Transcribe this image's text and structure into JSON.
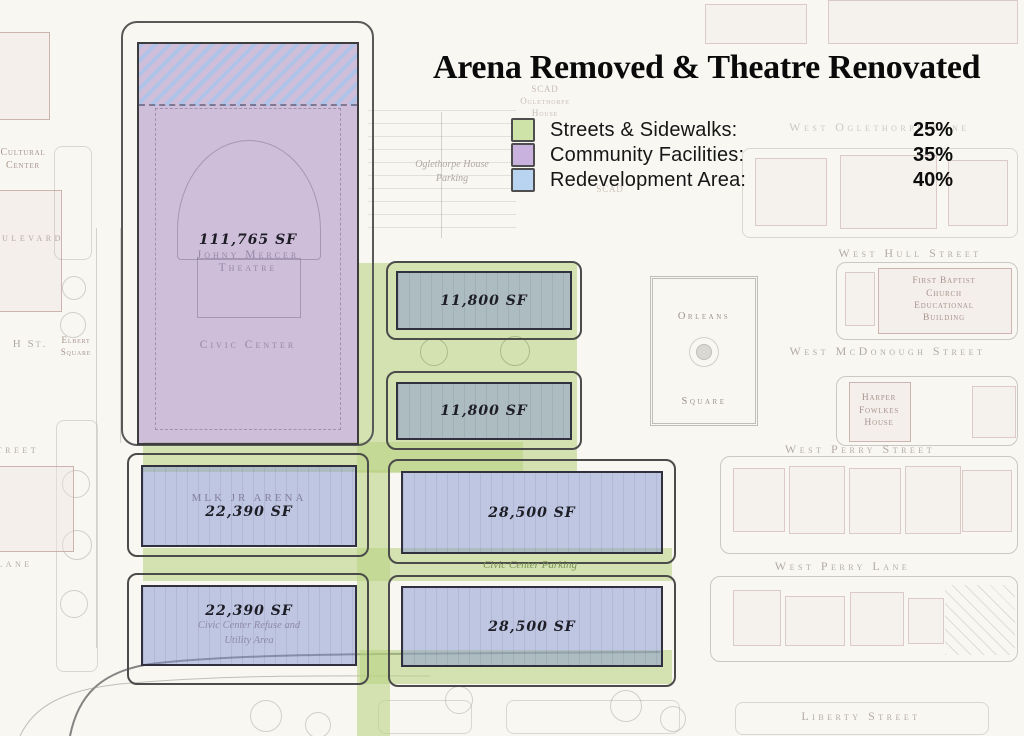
{
  "title": "Arena Removed & Theatre Renovated",
  "legend": {
    "items": [
      {
        "label": "Streets & Sidewalks:",
        "value": "25%",
        "color": "#cde3a7"
      },
      {
        "label": "Community Facilities:",
        "value": "35%",
        "color": "#c9b3de"
      },
      {
        "label": "Redevelopment Area:",
        "value": "40%",
        "color": "#b9d4f1"
      }
    ]
  },
  "colors": {
    "streets_overlay": "rgba(183,209,126,0.55)",
    "community_overlay": "rgba(158,120,188,0.45)",
    "redevelopment_overlay": "rgba(134,150,208,0.5)",
    "hatch_blue": "#a8c4ea"
  },
  "plan": {
    "theatre": {
      "area": "111,765 SF",
      "name": [
        "Johny Mercer",
        "Theatre"
      ],
      "facility": "Civic Center"
    },
    "blocks": [
      {
        "area": "11,800 SF"
      },
      {
        "area": "11,800 SF"
      },
      {
        "area": "22,390 SF",
        "ghost": "MLK JR ARENA"
      },
      {
        "area": "22,390 SF",
        "note": [
          "Civic Center Refuse and",
          "Utility Area"
        ]
      },
      {
        "area": "28,500 SF"
      },
      {
        "area": "28,500 SF"
      }
    ],
    "parking_label": "Civic Center Parking"
  },
  "map": {
    "streets": {
      "west_oglethorpe_lane": "West Oglethorpe Lane",
      "west_hull_street": "West Hull Street",
      "west_mcdonough_street": "West McDonough Street",
      "west_perry_street": "West Perry Street",
      "west_perry_lane": "West Perry Lane",
      "liberty_street": "Liberty Street",
      "boulevard_partial": "ulevard",
      "h_st": "H St.",
      "street_partial": "treet",
      "lane_partial": "lane"
    },
    "places": {
      "scad_house": [
        "SCAD",
        "Oglethorpe",
        "House"
      ],
      "oglethorpe_parking": [
        "Oglethorpe House",
        "Parking"
      ],
      "scad_small": "SCAD",
      "first_baptist": [
        "First Baptist",
        "Church",
        "Educational",
        "Building"
      ],
      "harper_fowlkes": [
        "Harper",
        "Fowlkes",
        "House"
      ],
      "orleans_square": [
        "Orleans",
        "Square"
      ],
      "elbert_square": [
        "Elbert",
        "Square"
      ],
      "cultural_center": [
        "Cultural",
        "Center"
      ]
    }
  }
}
